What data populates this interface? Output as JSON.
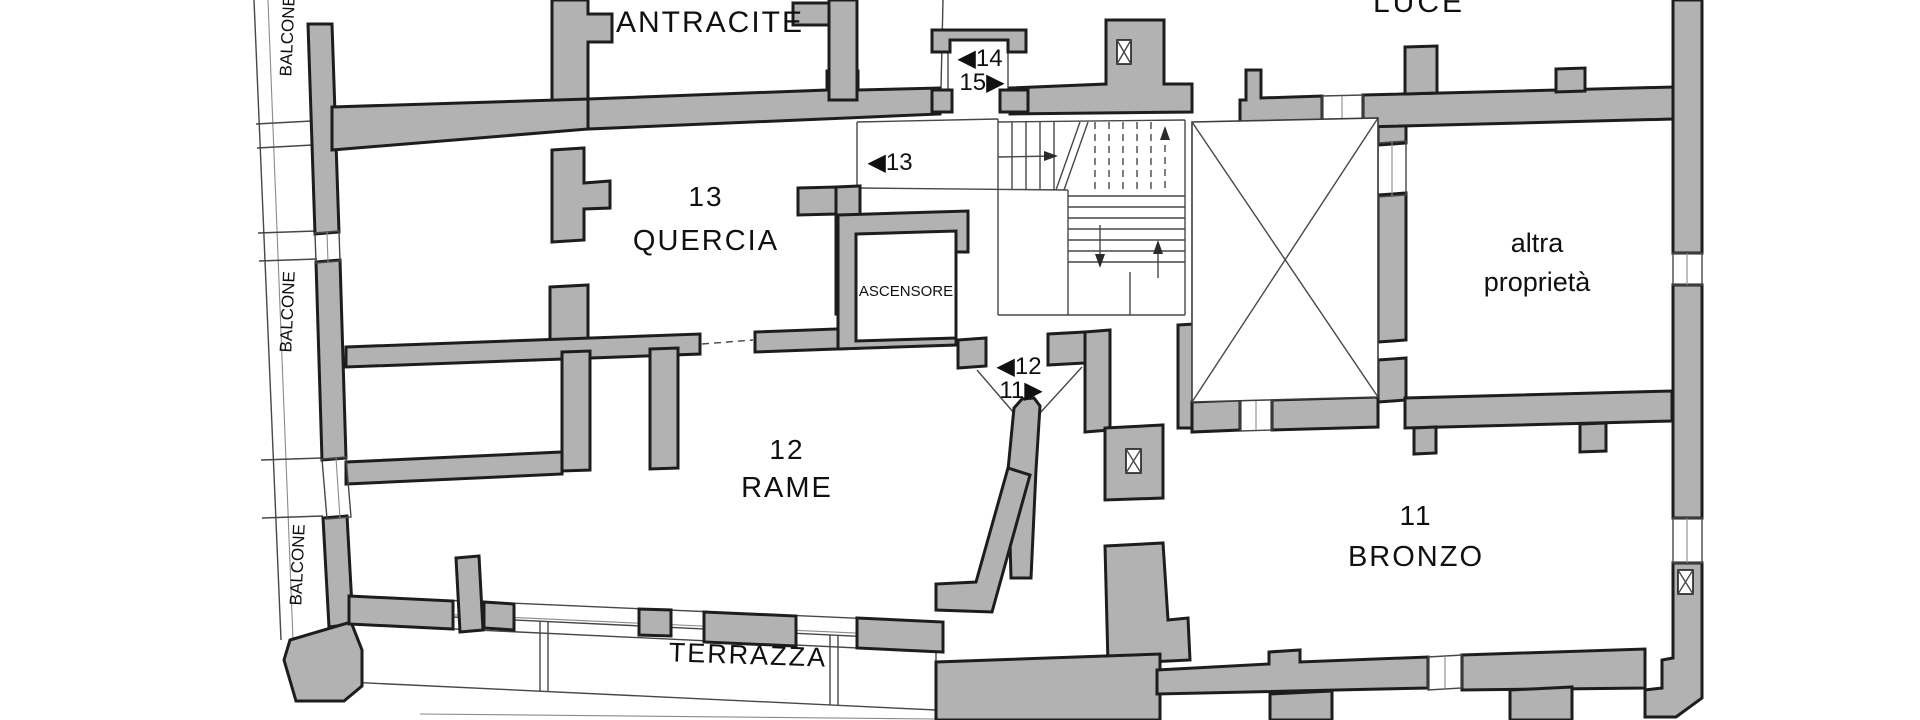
{
  "drawing": {
    "type": "floor-plan",
    "language": "italian"
  },
  "colors": {
    "wall_fill": "#b2b2b2",
    "wall_outline": "#1d1d1d",
    "thin_line": "#474747",
    "background": "#ffffff",
    "text": "#101010"
  },
  "rooms": {
    "antracite": {
      "name": "ANTRACITE"
    },
    "luce": {
      "name": "LUCE"
    },
    "quercia": {
      "number": "13",
      "name": "QUERCIA"
    },
    "rame": {
      "number": "12",
      "name": "RAME"
    },
    "bronzo": {
      "number": "11",
      "name": "BRONZO"
    },
    "altra_proprieta": {
      "line1": "altra",
      "line2": "proprietà"
    },
    "ascensore": {
      "name": "ASCENSORE"
    },
    "terrazza": {
      "name": "TERRAZZA"
    },
    "balcone_top": {
      "name": "BALCONE"
    },
    "balcone_mid": {
      "name": "BALCONE"
    },
    "balcone_bottom": {
      "name": "BALCONE"
    }
  },
  "entrance_markers": {
    "apt14": "◀14",
    "apt15": "15▶",
    "apt13": "◀13",
    "apt12": "◀12",
    "apt11": "11▶"
  }
}
